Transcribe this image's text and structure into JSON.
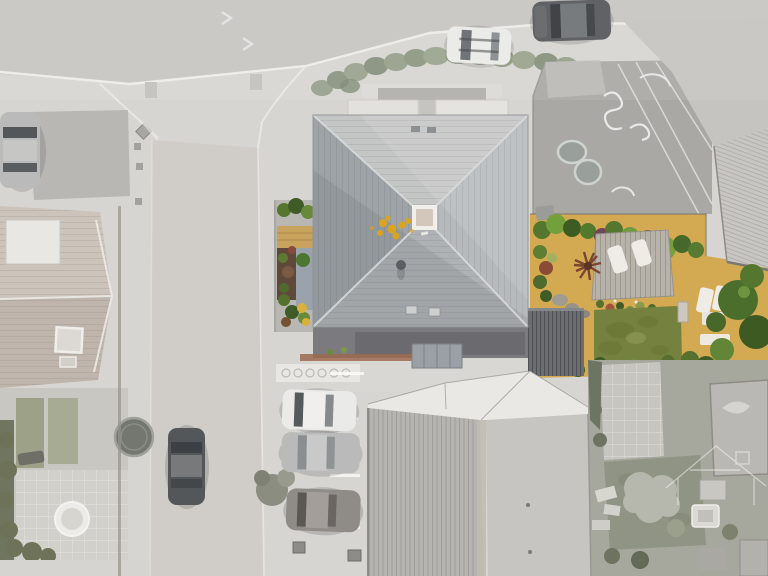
{
  "scene": {
    "type": "aerial-drone-photograph",
    "subject": "Top-down view of a detached house with a large pyramidal slate roof, central roof lantern and landscaped rear garden",
    "highlight_effect": "property shown in colour while surrounding streets, neighbouring houses and gardens are desaturated grey",
    "watermark": "faint white house-outline logo in lower right corner"
  },
  "vehicles": [
    {
      "id": "top-road-white-car",
      "location": "top road, parked",
      "color": "white"
    },
    {
      "id": "top-road-dark-car",
      "location": "top road, parked",
      "color": "dark grey"
    },
    {
      "id": "top-left-car",
      "location": "left driveway",
      "color": "silver"
    },
    {
      "id": "street-dark-car",
      "location": "side street, parked",
      "color": "dark grey"
    },
    {
      "id": "driveway-white-car",
      "location": "bottom parking bay 1",
      "color": "white"
    },
    {
      "id": "driveway-silver-car",
      "location": "bottom parking bay 2",
      "color": "silver"
    },
    {
      "id": "driveway-grey-car",
      "location": "bottom parking bay 3",
      "color": "grey-bronze"
    }
  ],
  "garden_features": [
    "boundary hedges",
    "golden gravel paths",
    "timber deck with two white sun loungers",
    "spiky cordyline plant",
    "rear lawn",
    "white garden furniture",
    "side border with bark mulch and slate chippings"
  ],
  "neighbourhood_features": [
    "hipped-roof house left",
    "trampoline",
    "round hot tub",
    "kidney-shaped pond",
    "large ribbed outbuilding roof bottom",
    "garden sheds bottom right"
  ],
  "colors": {
    "road": "#c7c5c2",
    "road_line": "#f1efec",
    "street": "#d0cdc9",
    "pavement": "#d7d5d1",
    "driveway_patch": "#b9b7b4",
    "neighbor_roof": "#c8beb5",
    "neighbor_flat_roof": "#e9e7e4",
    "patio_gray": "#d2d0cb",
    "trampoline": "#74776f",
    "hot_tub": "#ecebe7",
    "yard_concrete": "#a9a8a4",
    "pond": "#999f9b",
    "roof_north": "#c4c6c5",
    "roof_east": "#b6babc",
    "roof_south": "#aeb2b4",
    "roof_west": "#9da3a7",
    "ridge_line": "#dadbda",
    "skylight_frame": "#f1efeb",
    "skylight_glass": "#d3c7bc",
    "lichen": "#d9a41f",
    "extension_roof": "#6b6e71",
    "gravel_tan": "#d3aa52",
    "gravel_tan_muted": "#c7a35e",
    "mulch": "#60483a",
    "blue_gravel": "#9aa3ac",
    "deck": "#b7b3aa",
    "lawn": "#75813f",
    "lawn_dark": "#657230",
    "hedge_green": "#55762f",
    "hedge_bright": "#74a03c",
    "hedge_dark": "#3d5c22",
    "shrub_purple": "#6e4659",
    "white_furniture": "#efece7",
    "brick_edge": "#9c6a4f",
    "building_white": "#eae8e4",
    "building_ribbed": "#b5b4b1",
    "building_smooth": "#c6c5c2",
    "neighbor_ribbed_roof": "#c8c6c2",
    "bottomright_garden": "#a6a79d",
    "fluffy_tree": "#b6b7ad",
    "shed": "#bab8b4",
    "car_white": "#eaeae8",
    "car_dark": "#54575a",
    "car_silver": "#b9bab9",
    "car_bronze": "#8f8b87",
    "car_glass": "#454a4f",
    "tree_green": "#4c6e2d",
    "tree_green_light": "#628538",
    "watermark_line": "#ffffff"
  }
}
